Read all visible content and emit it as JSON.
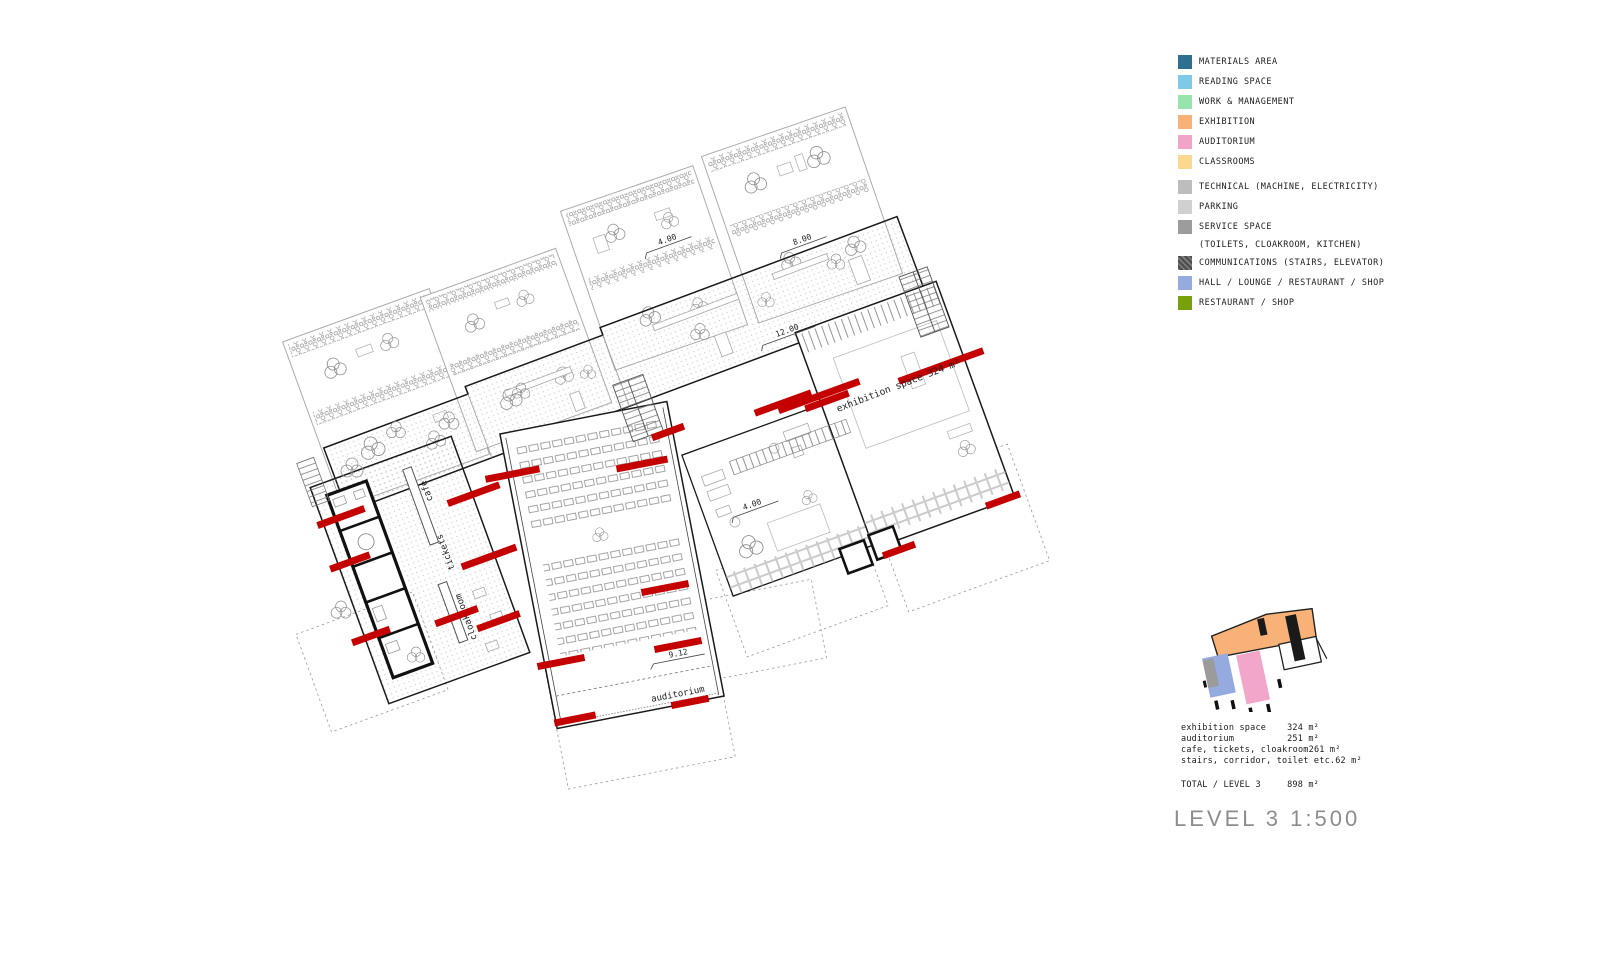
{
  "legend": {
    "items": [
      {
        "label": "MATERIALS AREA",
        "color": "#2e6e91"
      },
      {
        "label": "READING SPACE",
        "color": "#7ec9e8"
      },
      {
        "label": "WORK & MANAGEMENT",
        "color": "#97e4ad"
      },
      {
        "label": "EXHIBITION",
        "color": "#f8b278"
      },
      {
        "label": "AUDITORIUM",
        "color": "#f1a3c8"
      },
      {
        "label": "CLASSROOMS",
        "color": "#fbd88d"
      },
      {
        "label": "TECHNICAL (MACHINE, ELECTRICITY)",
        "color": "#bdbdbd"
      },
      {
        "label": "PARKING",
        "color": "#d0d0d0"
      },
      {
        "label": "SERVICE SPACE",
        "sublabel": "(TOILETS, CLOAKROOM, KITCHEN)",
        "color": "#9c9c9c"
      },
      {
        "label": "COMMUNICATIONS (STAIRS, ELEVATOR)",
        "color": "#4f4f4f"
      },
      {
        "label": "HALL / LOUNGE / RESTAURANT / SHOP",
        "color": "#95aade"
      },
      {
        "label": "RESTAURANT / SHOP",
        "color": "#77a00a"
      }
    ]
  },
  "plan": {
    "red_accent": "#c40000",
    "labels": {
      "level_12": "12.00",
      "level_4_upper": "4.00",
      "level_8": "8.00",
      "level_4_lounge": "4.00",
      "level_9_12": "9.12",
      "exhibition": "exhibition space  324 m²",
      "auditorium": "auditorium",
      "cafe": "cafe",
      "tickets": "tickets",
      "cloakroom": "cloakroom"
    }
  },
  "summary": {
    "rows": [
      {
        "label": "exhibition space",
        "value": "324 m²"
      },
      {
        "label": "auditorium",
        "value": "251 m²"
      },
      {
        "label": "cafe, tickets, cloakroom",
        "value": "261 m²"
      },
      {
        "label": "stairs, corridor, toilet etc.",
        "value": "62 m²"
      }
    ],
    "total": {
      "label": "TOTAL / LEVEL 3",
      "value": "898 m²"
    }
  },
  "title": "LEVEL 3 1:500"
}
